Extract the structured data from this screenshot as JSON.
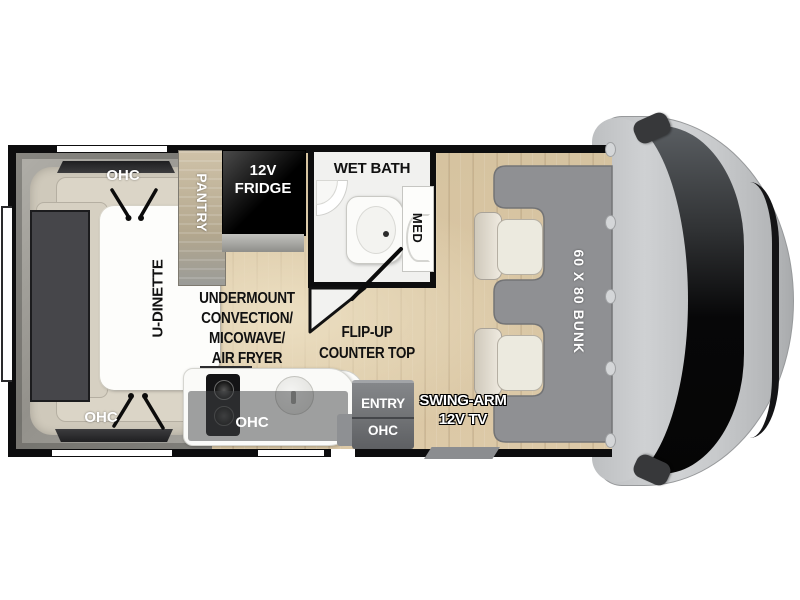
{
  "plan_labels": {
    "ohc": "OHC",
    "u_dinette": "U-DINETTE",
    "pantry": "PANTRY",
    "fridge": [
      "12V",
      "FRIDGE"
    ],
    "wet_bath": "WET BATH",
    "med": "MED",
    "undermount": [
      "UNDERMOUNT",
      "CONVECTION/",
      "MICOWAVE/",
      "AIR FRYER"
    ],
    "flip_up": [
      "FLIP-UP",
      "COUNTER TOP"
    ],
    "entry": "ENTRY",
    "swing_arm": [
      "SWING-ARM",
      "12V TV"
    ],
    "bunk": "60 X 80 BUNK"
  },
  "colors": {
    "wall": "#0d0d0e",
    "floor": "#d9c7a5",
    "bunk_pad": "#8f9093",
    "cab_body": "#c6c8ca",
    "windshield": "#0a0a0b",
    "cushion": "#dbd5c7",
    "table": "#fdfdfb",
    "bath_wall": "#f1f1ef",
    "fridge": "#0a0a0a",
    "pantry": "#bfb299",
    "entry_block": "#6f7174",
    "ohc_overlay": "rgba(66,68,70,0.5)",
    "label_dark": "#111111",
    "label_light": "#ffffff"
  }
}
